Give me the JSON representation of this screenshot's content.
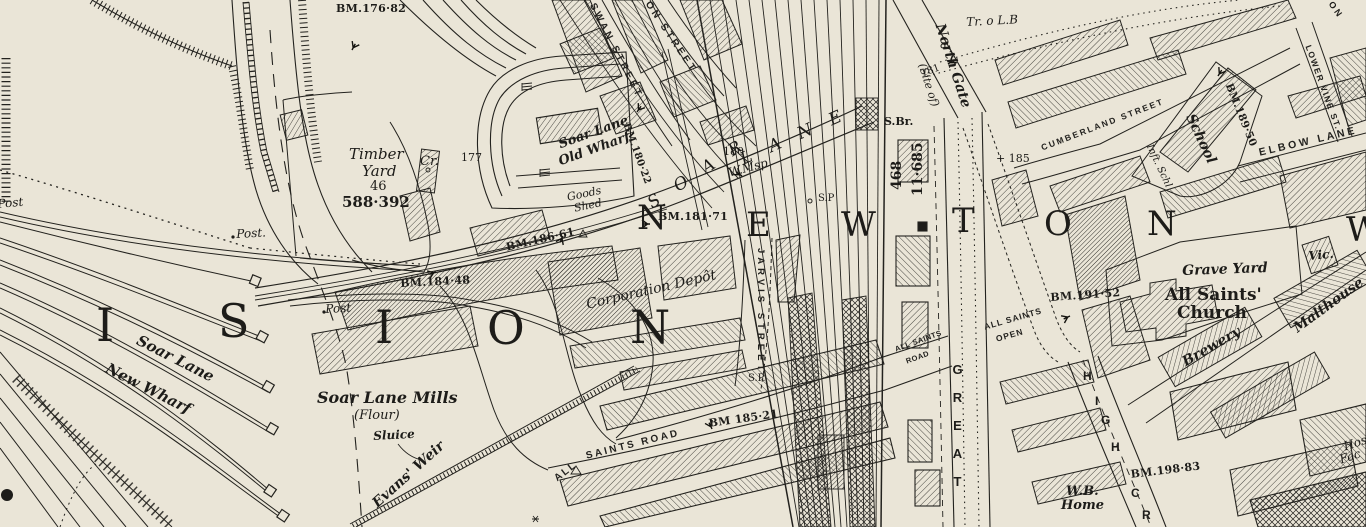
{
  "map": {
    "description_visible": "historic town-plan map sheet",
    "colors": {
      "paper": "#eae5d7",
      "ink": "#21201d"
    }
  },
  "labels": [
    {
      "id": "bm-176-82",
      "t": "BM.176·82",
      "x": 336,
      "y": 3,
      "r": 0,
      "c": "bm",
      "s": 11
    },
    {
      "id": "timber-yard-1",
      "t": "Timber",
      "x": 349,
      "y": 147,
      "r": 0,
      "c": "si",
      "s": 15
    },
    {
      "id": "timber-yard-2",
      "t": "Yard",
      "x": 362,
      "y": 164,
      "r": 0,
      "c": "si",
      "s": 15
    },
    {
      "id": "timber-yard-3",
      "t": "46",
      "x": 370,
      "y": 180,
      "r": 0,
      "c": "sn",
      "s": 13
    },
    {
      "id": "timber-yard-4",
      "t": "588·392",
      "x": 342,
      "y": 195,
      "r": 0,
      "c": "snb",
      "s": 15
    },
    {
      "id": "cr",
      "t": "Cr.",
      "x": 420,
      "y": 155,
      "r": 0,
      "c": "si",
      "s": 13
    },
    {
      "id": "height-177",
      "t": "177",
      "x": 461,
      "y": 152,
      "r": 0,
      "c": "sn",
      "s": 11
    },
    {
      "id": "old-wharf-1",
      "t": "Soar Lane",
      "x": 557,
      "y": 139,
      "r": -20,
      "c": "sib",
      "s": 13
    },
    {
      "id": "old-wharf-2",
      "t": "Old Wharf",
      "x": 557,
      "y": 156,
      "r": -20,
      "c": "sib",
      "s": 13
    },
    {
      "id": "goods-shed-1",
      "t": "Goods",
      "x": 566,
      "y": 192,
      "r": -12,
      "c": "si",
      "s": 11
    },
    {
      "id": "goods-shed-2",
      "t": "Shed",
      "x": 573,
      "y": 203,
      "r": -12,
      "c": "si",
      "s": 11
    },
    {
      "id": "swan-street",
      "t": "SWAN STREET",
      "x": 596,
      "y": 2,
      "r": 63,
      "c": "st",
      "s": 10,
      "ls": 3
    },
    {
      "id": "on-street",
      "t": "ON STREET",
      "x": 651,
      "y": 0,
      "r": 56,
      "c": "st",
      "s": 10,
      "ls": 3
    },
    {
      "id": "bm-180-22",
      "t": "BM.180·22",
      "x": 630,
      "y": 122,
      "r": 70,
      "c": "bm",
      "s": 10
    },
    {
      "id": "soar-lane-big-1",
      "t": "S O A R",
      "x": 645,
      "y": 198,
      "r": -33,
      "c": "soar",
      "s": 17
    },
    {
      "id": "soar-lane-big-2",
      "t": "L A N E",
      "x": 738,
      "y": 153,
      "r": -24,
      "c": "soar",
      "s": 17
    },
    {
      "id": "height-180-road",
      "t": "180",
      "x": 723,
      "y": 146,
      "r": 0,
      "c": "sn",
      "s": 11
    },
    {
      "id": "wmsp",
      "t": "W.Msp",
      "x": 727,
      "y": 167,
      "r": -15,
      "c": "si",
      "s": 12
    },
    {
      "id": "bm-181-71",
      "t": "BM.181·71",
      "x": 658,
      "y": 211,
      "r": 0,
      "c": "bm",
      "s": 11
    },
    {
      "id": "bm-186-61",
      "t": "BM.186·61",
      "x": 505,
      "y": 242,
      "r": -13,
      "c": "bm",
      "s": 11
    },
    {
      "id": "bm-184-48",
      "t": "BM.184·48",
      "x": 400,
      "y": 278,
      "r": -3,
      "c": "bm",
      "s": 11
    },
    {
      "id": "post-west",
      "t": "Post",
      "x": -3,
      "y": 198,
      "r": -5,
      "c": "si",
      "s": 12
    },
    {
      "id": "post-mid",
      "t": "Post.",
      "x": 236,
      "y": 228,
      "r": -3,
      "c": "si",
      "s": 12
    },
    {
      "id": "post-south",
      "t": "Post",
      "x": 325,
      "y": 303,
      "r": -3,
      "c": "si",
      "s": 12
    },
    {
      "id": "newton-n1",
      "t": "N",
      "x": 637,
      "y": 201,
      "r": 0,
      "c": "huge",
      "s": 34
    },
    {
      "id": "newton-e",
      "t": "E",
      "x": 746,
      "y": 208,
      "r": 0,
      "c": "huge",
      "s": 34
    },
    {
      "id": "newton-w",
      "t": "W",
      "x": 841,
      "y": 208,
      "r": 0,
      "c": "huge",
      "s": 34
    },
    {
      "id": "newton-t",
      "t": "T",
      "x": 952,
      "y": 204,
      "r": 0,
      "c": "huge",
      "s": 34
    },
    {
      "id": "newton-o",
      "t": "O",
      "x": 1044,
      "y": 207,
      "r": 0,
      "c": "huge",
      "s": 34
    },
    {
      "id": "newton-n2",
      "t": "N",
      "x": 1147,
      "y": 207,
      "r": 0,
      "c": "huge",
      "s": 34
    },
    {
      "id": "ward-w",
      "t": "W",
      "x": 1346,
      "y": 213,
      "r": 0,
      "c": "huge",
      "s": 34
    },
    {
      "id": "division-i1",
      "t": "I",
      "x": 96,
      "y": 302,
      "r": 0,
      "c": "huge",
      "s": 46
    },
    {
      "id": "division-s",
      "t": "S",
      "x": 218,
      "y": 298,
      "r": 0,
      "c": "huge",
      "s": 46
    },
    {
      "id": "division-i2",
      "t": "I",
      "x": 375,
      "y": 304,
      "r": 0,
      "c": "huge",
      "s": 46
    },
    {
      "id": "division-o",
      "t": "O",
      "x": 487,
      "y": 305,
      "r": 0,
      "c": "huge",
      "s": 46
    },
    {
      "id": "division-n",
      "t": "N",
      "x": 630,
      "y": 304,
      "r": 0,
      "c": "huge",
      "s": 46
    },
    {
      "id": "corporation-depot",
      "t": "Corporation Depôt",
      "x": 585,
      "y": 298,
      "r": -13,
      "c": "si",
      "s": 14
    },
    {
      "id": "jarvis-street",
      "t": "JARVIS STREET",
      "x": 765,
      "y": 248,
      "r": 90,
      "c": "st",
      "s": 9.5,
      "ls": 4
    },
    {
      "id": "sp-north",
      "t": "S.P",
      "x": 818,
      "y": 194,
      "r": 0,
      "c": "sn",
      "s": 10
    },
    {
      "id": "sp-south",
      "t": "S.P.",
      "x": 748,
      "y": 374,
      "r": 0,
      "c": "sn",
      "s": 10
    },
    {
      "id": "s-br",
      "t": "S.Br.",
      "x": 884,
      "y": 116,
      "r": 0,
      "c": "snb",
      "s": 11
    },
    {
      "id": "parcel-468",
      "t": "468",
      "x": 890,
      "y": 190,
      "r": -90,
      "c": "snb",
      "s": 14
    },
    {
      "id": "area-11-685",
      "t": "11·685",
      "x": 911,
      "y": 196,
      "r": -90,
      "c": "snb",
      "s": 14
    },
    {
      "id": "north-gate-1",
      "t": "North Gate",
      "x": 946,
      "y": 22,
      "r": 72,
      "c": "sib",
      "s": 14
    },
    {
      "id": "north-gate-2",
      "t": "(Site of)",
      "x": 927,
      "y": 62,
      "r": 72,
      "c": "si",
      "s": 11
    },
    {
      "id": "height-181",
      "t": "181",
      "x": 920,
      "y": 70,
      "r": -20,
      "c": "sn",
      "s": 10
    },
    {
      "id": "tr-lb",
      "t": "Tr. o L.B",
      "x": 966,
      "y": 16,
      "r": -3,
      "c": "si",
      "s": 12
    },
    {
      "id": "corner-on",
      "t": "O N",
      "x": 1334,
      "y": 0,
      "r": 55,
      "c": "stl",
      "s": 9
    },
    {
      "id": "cumberland-street",
      "t": "CUMBERLAND STREET",
      "x": 1040,
      "y": 144,
      "r": -21,
      "c": "st",
      "s": 8.5,
      "ls": 2
    },
    {
      "id": "bm-189-50",
      "t": "BM.189·50",
      "x": 1233,
      "y": 82,
      "r": 68,
      "c": "bm",
      "s": 10.5
    },
    {
      "id": "school",
      "t": "School",
      "x": 1196,
      "y": 112,
      "r": 65,
      "c": "sib",
      "s": 14
    },
    {
      "id": "infant-school",
      "t": "Inft. Schl",
      "x": 1153,
      "y": 143,
      "r": 65,
      "c": "si",
      "s": 10
    },
    {
      "id": "lower-vine-st",
      "t": "LOWER VINE ST.",
      "x": 1312,
      "y": 44,
      "r": 70,
      "c": "st",
      "s": 8.5,
      "ls": 1.5
    },
    {
      "id": "elbow-lane",
      "t": "ELBOW LANE",
      "x": 1258,
      "y": 148,
      "r": -13,
      "c": "st",
      "s": 10.5,
      "ls": 3
    },
    {
      "id": "height-185",
      "t": "+ 185",
      "x": 996,
      "y": 153,
      "r": 0,
      "c": "sn",
      "s": 11
    },
    {
      "id": "bm-191-52",
      "t": "BM.191·52",
      "x": 1050,
      "y": 292,
      "r": -4,
      "c": "bm",
      "s": 11
    },
    {
      "id": "all-saints-open-1",
      "t": "ALL SAINTS",
      "x": 983,
      "y": 323,
      "r": -16,
      "c": "st",
      "s": 8.5,
      "ls": 1
    },
    {
      "id": "all-saints-open-2",
      "t": "OPEN",
      "x": 995,
      "y": 335,
      "r": -16,
      "c": "st",
      "s": 8.5,
      "ls": 1
    },
    {
      "id": "all-saints-road-sm-1",
      "t": "ALL SAINTS",
      "x": 894,
      "y": 346,
      "r": -20,
      "c": "st",
      "s": 7.5,
      "ls": 0.5
    },
    {
      "id": "all-saints-road-sm-2",
      "t": "ROAD",
      "x": 905,
      "y": 358,
      "r": -20,
      "c": "st",
      "s": 7.5,
      "ls": 0.5
    },
    {
      "id": "great-street",
      "t": "GREAT",
      "x": 951,
      "y": 362,
      "r": 0,
      "c": "vert",
      "s": 13,
      "ls": 13
    },
    {
      "id": "high-h1",
      "t": "H",
      "x": 1083,
      "y": 370,
      "r": 0,
      "c": "stl",
      "s": 12
    },
    {
      "id": "high-i",
      "t": "I",
      "x": 1095,
      "y": 395,
      "r": 0,
      "c": "stl",
      "s": 12
    },
    {
      "id": "high-g",
      "t": "G",
      "x": 1101,
      "y": 414,
      "r": 0,
      "c": "stl",
      "s": 12
    },
    {
      "id": "high-h2",
      "t": "H",
      "x": 1111,
      "y": 441,
      "r": 0,
      "c": "stl",
      "s": 12
    },
    {
      "id": "cross-c",
      "t": "C",
      "x": 1131,
      "y": 487,
      "r": 0,
      "c": "stl",
      "s": 12
    },
    {
      "id": "cross-r",
      "t": "R",
      "x": 1142,
      "y": 509,
      "r": 0,
      "c": "stl",
      "s": 12
    },
    {
      "id": "wb-home-1",
      "t": "W.B.",
      "x": 1066,
      "y": 485,
      "r": 0,
      "c": "sib",
      "s": 13
    },
    {
      "id": "wb-home-2",
      "t": "Home",
      "x": 1061,
      "y": 499,
      "r": 0,
      "c": "sib",
      "s": 13
    },
    {
      "id": "bm-198-83",
      "t": "BM.198·83",
      "x": 1130,
      "y": 469,
      "r": -7,
      "c": "bm",
      "s": 11
    },
    {
      "id": "hosiery-1",
      "t": "Hos",
      "x": 1342,
      "y": 441,
      "r": -18,
      "c": "si",
      "s": 12
    },
    {
      "id": "hosiery-2",
      "t": "Fac",
      "x": 1338,
      "y": 454,
      "r": -18,
      "c": "si",
      "s": 12
    },
    {
      "id": "grave-yard",
      "t": "Grave Yard",
      "x": 1182,
      "y": 264,
      "r": -2,
      "c": "sib",
      "s": 14
    },
    {
      "id": "church-1",
      "t": "All Saints'",
      "x": 1165,
      "y": 287,
      "r": 0,
      "c": "snb",
      "s": 17
    },
    {
      "id": "church-2",
      "t": "Church",
      "x": 1177,
      "y": 305,
      "r": 0,
      "c": "snb",
      "s": 17
    },
    {
      "id": "vicarage",
      "t": "Vic.",
      "x": 1308,
      "y": 250,
      "r": -5,
      "c": "sib",
      "s": 12
    },
    {
      "id": "malthouse",
      "t": "Malthouse",
      "x": 1291,
      "y": 324,
      "r": -36,
      "c": "sib",
      "s": 14
    },
    {
      "id": "brewery",
      "t": "Brewery",
      "x": 1180,
      "y": 357,
      "r": -30,
      "c": "sib",
      "s": 14
    },
    {
      "id": "all-saints-road-1",
      "t": "ALL",
      "x": 553,
      "y": 476,
      "r": -38,
      "c": "st",
      "s": 10,
      "ls": 2
    },
    {
      "id": "all-saints-road-2",
      "t": "SAINTS  ROAD",
      "x": 585,
      "y": 452,
      "r": -14,
      "c": "st",
      "s": 10,
      "ls": 2.5
    },
    {
      "id": "bm-185-21",
      "t": "BM 185·21",
      "x": 708,
      "y": 418,
      "r": -8,
      "c": "bm",
      "s": 11
    },
    {
      "id": "mills-1",
      "t": "Soar Lane Mills",
      "x": 317,
      "y": 390,
      "r": 0,
      "c": "sib",
      "s": 16
    },
    {
      "id": "mills-2",
      "t": "(Flour)",
      "x": 354,
      "y": 409,
      "r": 0,
      "c": "si",
      "s": 13
    },
    {
      "id": "sluice",
      "t": "Sluice",
      "x": 373,
      "y": 430,
      "r": -3,
      "c": "sib",
      "s": 12
    },
    {
      "id": "evans-weir",
      "t": "Evans' Weir",
      "x": 370,
      "y": 500,
      "r": -42,
      "c": "sib",
      "s": 14
    },
    {
      "id": "new-wharf-1",
      "t": "Soar Lane",
      "x": 141,
      "y": 333,
      "r": 27,
      "c": "sib",
      "s": 15
    },
    {
      "id": "new-wharf-2",
      "t": "New Wharf",
      "x": 110,
      "y": 361,
      "r": 27,
      "c": "sib",
      "s": 15
    }
  ]
}
